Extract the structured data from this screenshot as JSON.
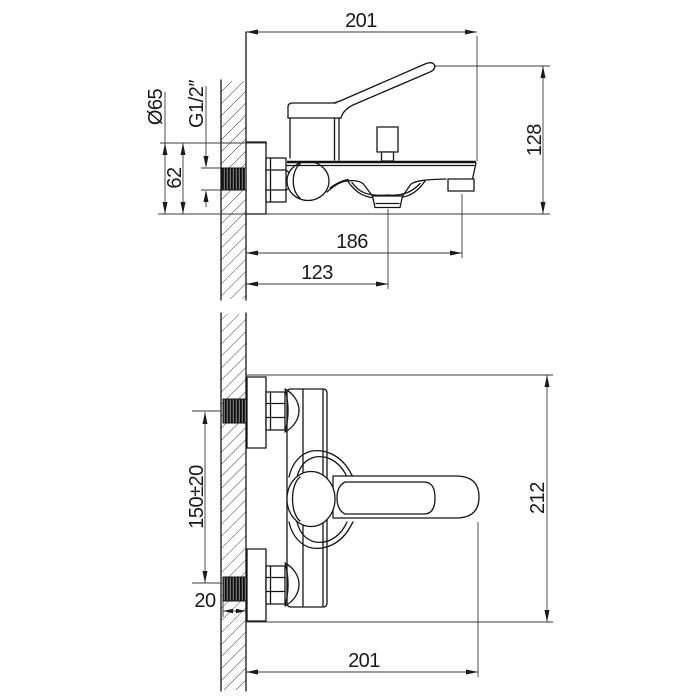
{
  "title": "Bath mixer faucet installation drawing, two orthographic views",
  "views": {
    "side_view": {
      "name": "side view with wall section",
      "dimensions": {
        "wall_to_spout_tip": "201",
        "overall_height_to_handle": "128",
        "escutcheon_diameter": "Ø65",
        "connection_thread": "G1/2″",
        "escutcheon_height": "62",
        "wall_to_spout_outlet": "186",
        "wall_to_shower_outlet": "123"
      }
    },
    "front_view": {
      "name": "front view with wall section",
      "dimensions": {
        "overall_height": "212",
        "supply_centers_spacing": "150±20",
        "in_wall_thread_length": "20",
        "wall_to_handle_tip": "201"
      }
    }
  },
  "colors": {
    "line": "#1a1a1a",
    "background": "#ffffff"
  }
}
